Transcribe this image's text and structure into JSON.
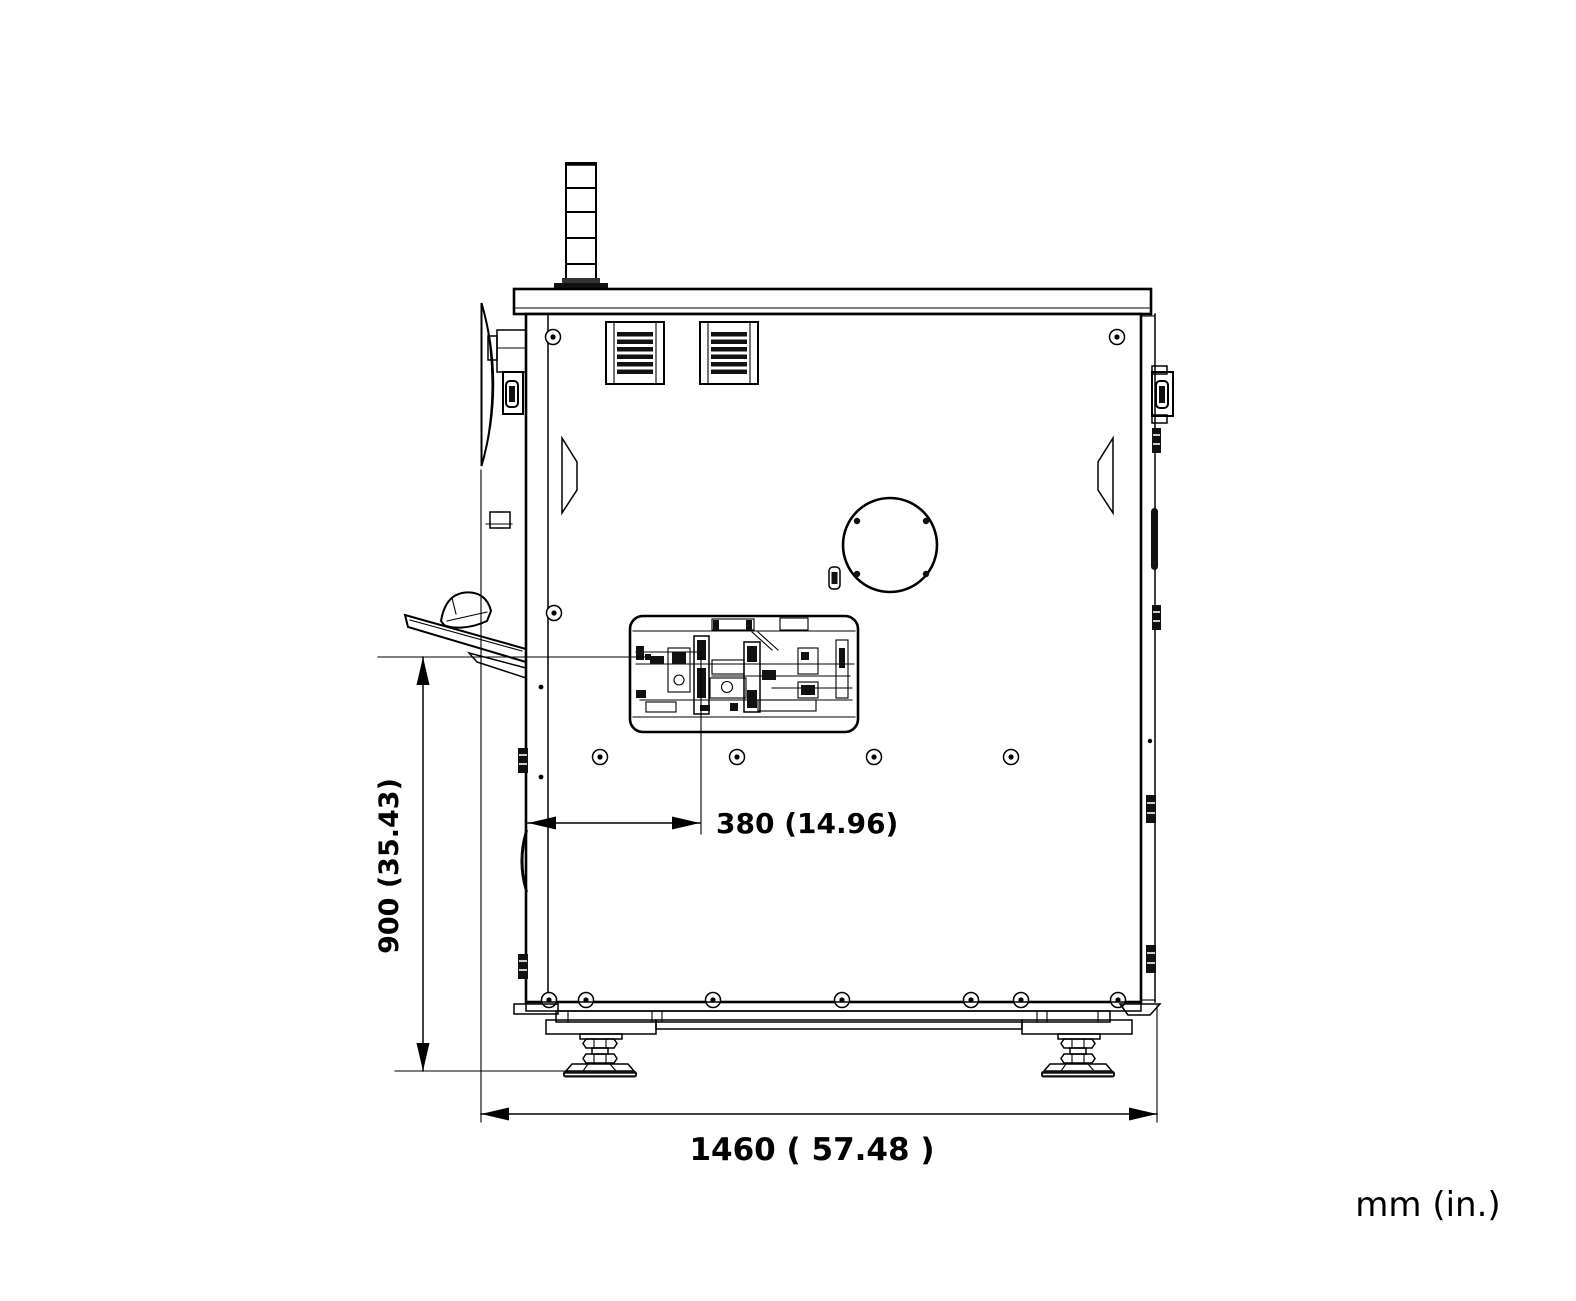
{
  "drawing": {
    "units_label": "mm (in.)",
    "dimensions": {
      "height": {
        "label": "900 (35.43)",
        "value_mm": 900,
        "value_in": 35.43
      },
      "offset": {
        "label": "380 (14.96)",
        "value_mm": 380,
        "value_in": 14.96
      },
      "width": {
        "label": "1460 ( 57.48 )",
        "value_mm": 1460,
        "value_in": 57.48
      }
    }
  }
}
